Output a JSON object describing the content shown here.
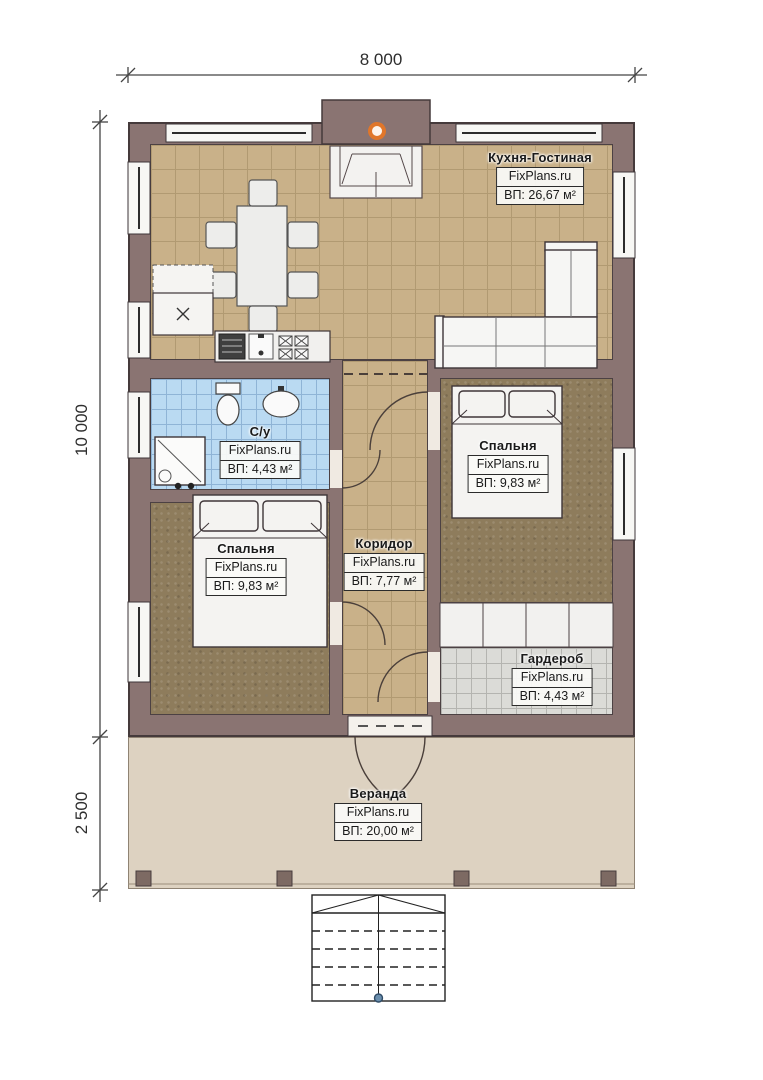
{
  "dimensions": {
    "width_total": "8 000",
    "depth_main": "10 000",
    "depth_veranda": "2 500"
  },
  "brand": "FixPlans.ru",
  "rooms": [
    {
      "key": "kitchen-living",
      "name": "Кухня-Гостиная",
      "brand": "FixPlans.ru",
      "area": "ВП: 26,67 м²"
    },
    {
      "key": "bathroom",
      "name": "С/у",
      "brand": "FixPlans.ru",
      "area": "ВП: 4,43 м²"
    },
    {
      "key": "bedroom-right",
      "name": "Спальня",
      "brand": "FixPlans.ru",
      "area": "ВП: 9,83 м²"
    },
    {
      "key": "corridor",
      "name": "Коридор",
      "brand": "FixPlans.ru",
      "area": "ВП: 7,77 м²"
    },
    {
      "key": "bedroom-left",
      "name": "Спальня",
      "brand": "FixPlans.ru",
      "area": "ВП: 9,83 м²"
    },
    {
      "key": "wardrobe",
      "name": "Гардероб",
      "brand": "FixPlans.ru",
      "area": "ВП: 4,43 м²"
    },
    {
      "key": "veranda",
      "name": "Веранда",
      "brand": "FixPlans.ru",
      "area": "ВП: 20,00 м²"
    }
  ],
  "colors": {
    "wall": "#8a7472",
    "tile_floor": "#c9b189",
    "bedroom_floor": "#8e7c5c",
    "bathroom_tile": "#badaf2",
    "wardrobe_tile": "#dbdbd7",
    "veranda_floor": "#ddd2c1",
    "fixture_white": "#f4f3f1",
    "chimney_accent": "#e0762a"
  }
}
